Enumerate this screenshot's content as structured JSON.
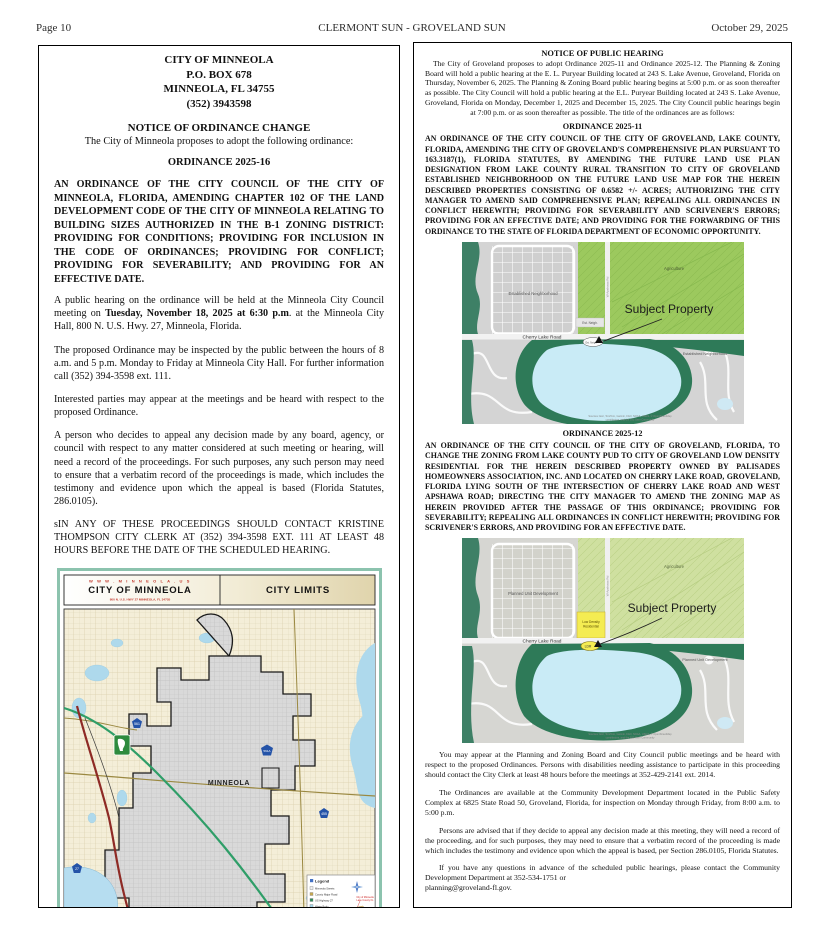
{
  "header": {
    "page_number": "Page 10",
    "publication": "CLERMONT SUN  - GROVELAND SUN",
    "date": "October 29, 2025"
  },
  "colors": {
    "agriculture_green": "#9cc95e",
    "agriculture_pale": "#cfe0a0",
    "conservation_green": "#2e7a58",
    "water_blue": "#c9ebf6",
    "ldr_yellow": "#f4ec52",
    "city_gray": "#d9d9d9",
    "highway_red": "#8e2a25",
    "turnpike_green": "#2f9e68",
    "shield_blue": "#2453a8",
    "map_frame_teal": "#8cc3ae"
  },
  "minneola": {
    "org_lines": [
      "CITY OF MINNEOLA",
      "P.O. BOX 678",
      "MINNEOLA, FL 34755",
      "(352) 3943598"
    ],
    "notice_title": "NOTICE OF ORDINANCE CHANGE",
    "intro": "The City of Minneola proposes to adopt the following ordinance:",
    "ordinance_no": "ORDINANCE 2025-16",
    "ordinance_title": "AN ORDINANCE OF THE CITY COUNCIL OF THE CITY OF MINNEOLA, FLORIDA, AMENDING CHAPTER 102 OF THE LAND DEVELOPMENT CODE OF THE CITY OF MINNEOLA RELATING TO BUILDING SIZES AUTHORIZED IN THE B-1 ZONING DISTRICT: PROVIDING FOR CONDITIONS; PROVIDING FOR INCLUSION IN THE CODE OF ORDINANCES; PROVIDING FOR CONFLICT; PROVIDING FOR SEVERABILITY; AND PROVIDING FOR AN EFFECTIVE DATE.",
    "hearing": {
      "pre": "A public hearing on the ordinance will be held at the Minneola City Council meeting on ",
      "bold": "Tuesday, November 18, 2025 at 6:30 p.m",
      "post": ". at the Minneola City Hall, 800 N. U.S. Hwy. 27, Minneola, Florida."
    },
    "paragraphs": {
      "inspect": "The proposed Ordinance may be inspected by the public between the hours of 8 a.m. and 5 p.m. Monday to Friday at Minneola City Hall. For further information call (352) 394-3598 ext. 111.",
      "interested": "Interested parties may appear at the meetings and be heard with respect to the proposed Ordinance.",
      "appeal": "A person who decides to appeal any decision made by any board, agency, or council with respect to any matter considered at such meeting or hearing, will need a record of the proceedings. For such purposes, any such person may need to ensure that a verbatim record of the proceedings is made, which includes the testimony and evidence upon which the appeal is based (Florida Statutes, 286.0105).",
      "contact": "sIN ANY OF THESE PROCEEDINGS SHOULD CONTACT KRISTINE THOMPSON CITY CLERK AT (352) 394-3598 EXT. 111 AT LEAST 48 HOURS BEFORE THE DATE OF THE SCHEDULED HEARING."
    },
    "map": {
      "website": "W W W . M I N N E O L A . U S",
      "title": "CITY OF MINNEOLA",
      "address": "800 N. U.S. HWY 27 MINNEOLA, FL  34755",
      "right_title": "CITY LIMITS",
      "city_label": "MINNEOLA",
      "lake_label": "Lake Minneola",
      "shields": {
        "s561": "561",
        "s561a": "561A",
        "s455": "455",
        "s27": "27"
      },
      "legend": {
        "title": "Legend",
        "items": [
          "Minneola Streets",
          "County Major Road",
          "US Highway 27",
          "Water Body"
        ],
        "inset_label_1": "City of Minneola",
        "inset_label_2": "Lake County FL",
        "scale_text": "1 INCH EQUALS 0.5 MILES",
        "disclaimer_lines": [
          "Disclaimer: This map is for general",
          "reference only and is not a survey.",
          "The City of Minneola assumes no",
          "liability for errors or omissions.",
          "Produced by the City of Minneola."
        ]
      }
    }
  },
  "groveland": {
    "notice_title": "NOTICE OF PUBLIC HEARING",
    "intro": "The City of Groveland proposes to adopt Ordinance 2025-11 and Ordinance 2025-12.  The Planning & Zoning Board will hold a public hearing at the E. L. Puryear Building located at 243 S. Lake Avenue, Groveland, Florida on Thursday, November 6, 2025. The Planning & Zoning Board public hearing begins at 5:00 p.m. or as soon thereafter as possible. The City Council will hold a public hearing at the E.L. Puryear Building located at 243 S. Lake Avenue, Groveland, Florida on Monday, December 1, 2025 and December 15, 2025. The City Council public hearings begin at 7:00 p.m. or as soon thereafter as possible.  The title of the ordinances are as follows:",
    "ord11": {
      "heading": "ORDINANCE 2025-11",
      "body": "AN ORDINANCE OF THE CITY COUNCIL OF THE CITY OF GROVELAND, LAKE COUNTY, FLORIDA, AMENDING THE CITY OF GROVELAND'S COMPREHENSIVE PLAN PURSUANT TO 163.3187(1), FLORIDA STATUTES, BY AMENDING THE FUTURE LAND USE PLAN DESIGNATION FROM LAKE COUNTY RURAL TRANSITION TO CITY OF GROVELAND ESTABLISHED NEIGHBORHOOD ON THE FUTURE LAND USE MAP FOR THE HEREIN DESCRIBED PROPERTIES CONSISTING OF 0.6582 +/- ACRES; AUTHORIZING THE CITY MANAGER TO AMEND SAID COMPREHENSIVE PLAN; REPEALING ALL ORDINANCES IN CONFLICT HEREWITH; PROVIDING FOR SEVERABILITY AND SCRIVENER'S ERRORS; PROVIDING FOR AN EFFECTIVE DATE; AND PROVIDING FOR THE FORWARDING OF THIS ORDINANCE TO THE STATE OF FLORIDA DEPARTMENT OF ECONOMIC OPPORTUNITY."
    },
    "ord12": {
      "heading": "ORDINANCE 2025-12",
      "body": "AN ORDINANCE OF THE CITY COUNCIL OF THE CITY OF GROVELAND, FLORIDA, TO CHANGE THE ZONING FROM LAKE COUNTY PUD TO CITY OF GROVELAND LOW DENSITY RESIDENTIAL FOR THE HEREIN DESCRIBED PROPERTY OWNED BY PALISADES HOMEOWNERS ASSOCIATION, INC. AND LOCATED ON CHERRY LAKE ROAD, GROVELAND, FLORIDA LYING SOUTH OF THE INTERSECTION OF CHERRY LAKE ROAD AND WEST APSHAWA ROAD; DIRECTING THE CITY MANAGER TO AMEND THE ZONING MAP AS HEREIN PROVIDED AFTER THE PASSAGE OF THIS ORDINANCE; PROVIDING FOR SEVERABILITY; REPEALING ALL ORDINANCES IN CONFLICT HEREWITH; PROVIDING FOR SCRIVENER'S ERRORS, AND PROVIDING FOR AN EFFECTIVE DATE."
    },
    "map11": {
      "agriculture": "Agriculture",
      "neighborhood_label": "Established Neighborhood",
      "small_label": "Est.  Neigh.",
      "parcel_label": "Est. Neigh",
      "subject": "Subject Property",
      "road": "Cherry Lake Road",
      "side_road": "W Apshawa Rd",
      "bottom_label": "Established Neighborhood",
      "attribution_1": "Sources: Esri, TomTom, Garmin, FAO, NOAA, USGS, © OpenStreetMap",
      "attribution_2": "contributors, and the GIS User Community"
    },
    "map12": {
      "agriculture": "Agriculture",
      "neighborhood_label": "Planned Unit Development",
      "ldr_line1": "Low Density",
      "ldr_line2": "Residential",
      "ldr_pill": "LDR",
      "subject": "Subject Property",
      "road": "Cherry Lake Road",
      "side_road": "W Apshawa Rd",
      "bottom_label": "Planned Unit Development",
      "attribution_1": "Sources: Esri, TomTom, Garmin, FAO, NOAA, USGS, © OpenStreetMap",
      "attribution_2": "contributors, and the GIS User Community"
    },
    "para_appear": "You may appear at the Planning and Zoning Board and City Council public meetings and be heard with respect to the proposed Ordinances. Persons with disabilities needing assistance to participate in this proceeding should contact the City Clerk at least 48 hours before the meetings at 352-429-2141 ext. 2014.",
    "para_available": "The Ordinances are available at the Community Development Department located in the Public Safety Complex at 6825 State Road 50, Groveland, Florida, for inspection on Monday through Friday, from 8:00 a.m. to 5:00 p.m.",
    "para_appeal": "Persons are advised that if they decide to appeal any decision made at this meeting, they will need a record of the proceeding, and for such purposes, they may need to ensure that a verbatim record of the proceeding is made which includes the testimony and evidence upon which the appeal is based, per Section 286.0105, Florida Statutes.",
    "para_questions": "If you have any questions in advance of the scheduled public hearings, please contact the Community Development Department at 352-534-1751 or",
    "para_email": "planning@groveland-fl.gov."
  }
}
